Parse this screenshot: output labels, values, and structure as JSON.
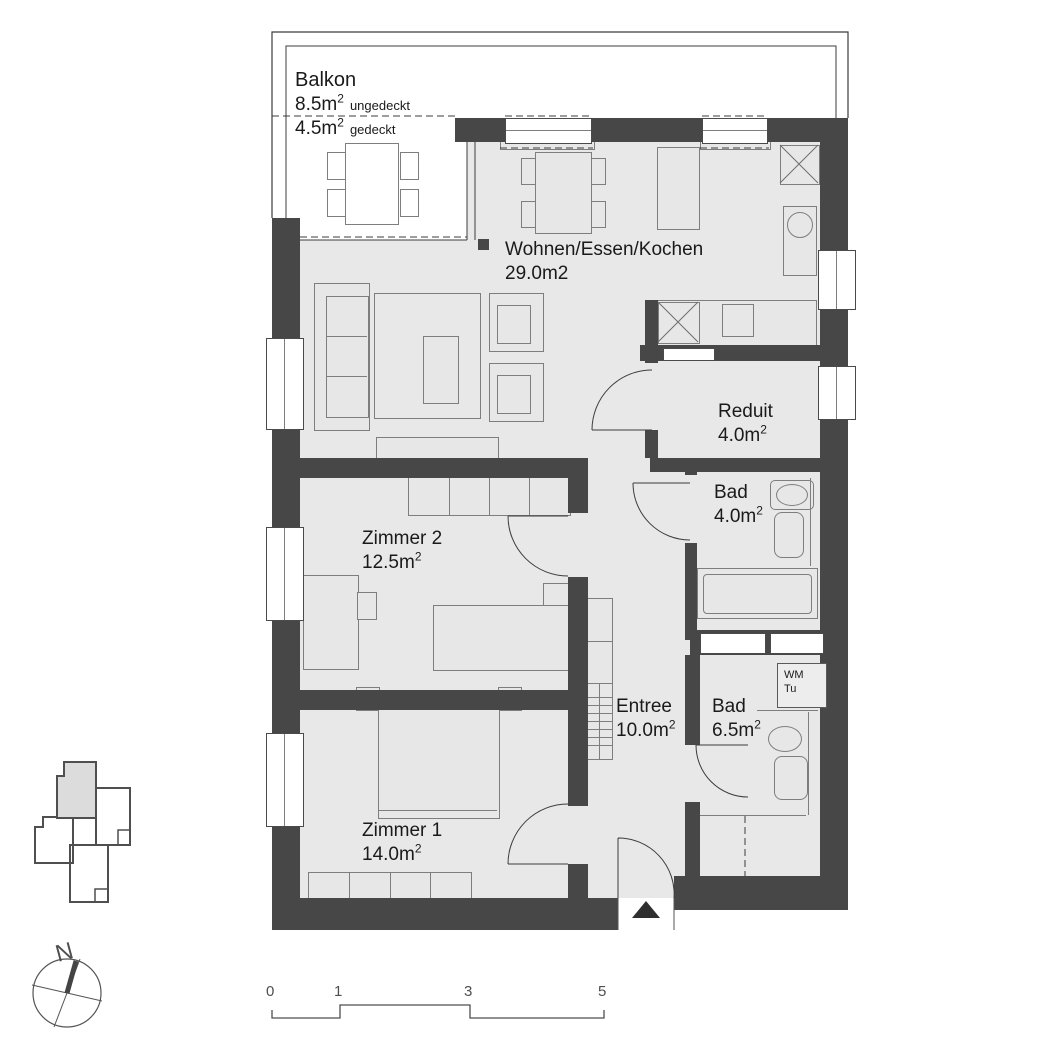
{
  "colors": {
    "wall": "#474747",
    "floor": "#e8e8e8",
    "line": "#7e7e7e",
    "highlight": "#dcdcdc"
  },
  "balcony": {
    "name": "Balkon",
    "area1": "8.5m",
    "area1_sup": "2",
    "area1_suffix": "ungedeckt",
    "area2": "4.5m",
    "area2_sup": "2",
    "area2_suffix": "gedeckt"
  },
  "rooms": [
    {
      "id": "wohnen",
      "name": "Wohnen/Essen/Kochen",
      "area": "29.0m2",
      "sup": ""
    },
    {
      "id": "reduit",
      "name": "Reduit",
      "area": "4.0m",
      "sup": "2"
    },
    {
      "id": "bad-oben",
      "name": "Bad",
      "area": "4.0m",
      "sup": "2"
    },
    {
      "id": "zimmer2",
      "name": "Zimmer 2",
      "area": "12.5m",
      "sup": "2"
    },
    {
      "id": "entree",
      "name": "Entree",
      "area": "10.0m",
      "sup": "2"
    },
    {
      "id": "bad-unten",
      "name": "Bad",
      "area": "6.5m",
      "sup": "2"
    },
    {
      "id": "zimmer1",
      "name": "Zimmer 1",
      "area": "14.0m",
      "sup": "2"
    }
  ],
  "appliances": {
    "wm": "WM",
    "tu": "Tu"
  },
  "compass": {
    "label": "N"
  },
  "scale": {
    "labels": [
      "0",
      "1",
      "3",
      "5"
    ]
  }
}
